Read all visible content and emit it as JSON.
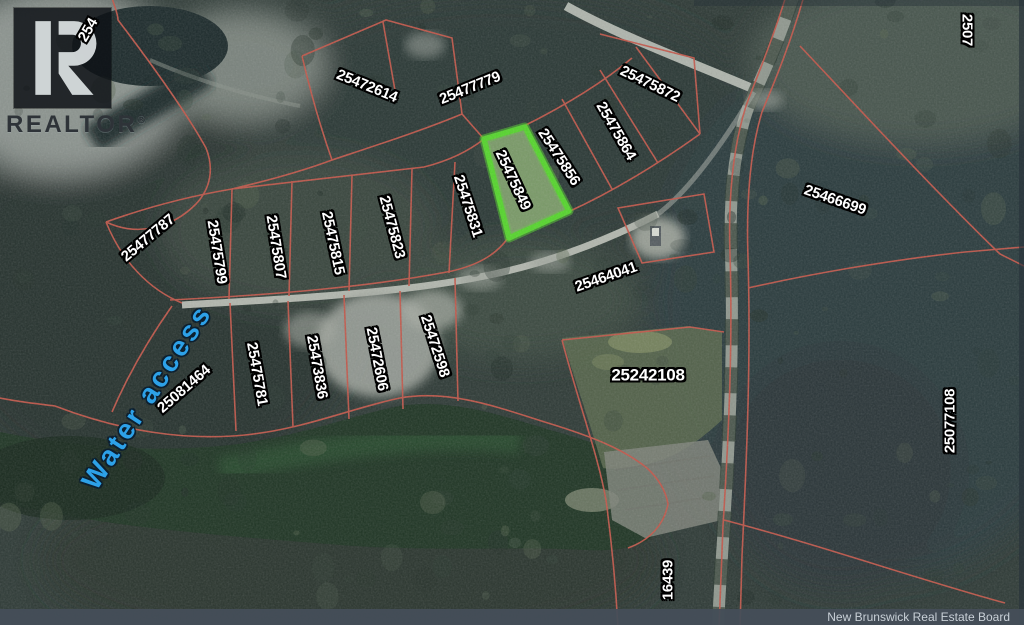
{
  "map": {
    "attribution": "New Brunswick Real Estate Board",
    "water_label": {
      "text": "Water access",
      "color": "#2da1e8",
      "rotation": -57
    },
    "logo": {
      "brand": "REALTOR",
      "registered": "®",
      "glyph": "R"
    },
    "highlight": {
      "parcel_id": "25475849",
      "border_color": "#55d42c"
    },
    "colors": {
      "parcel_line": "#c2574a",
      "label_fill": "#ffffff",
      "water": "#1f3524",
      "forest": "#2e3a36"
    },
    "parcels": [
      {
        "id": "254",
        "x": 88,
        "y": 30,
        "rot": -60,
        "partial": true
      },
      {
        "id": "25472614",
        "x": 367,
        "y": 86,
        "rot": 22
      },
      {
        "id": "25477779",
        "x": 470,
        "y": 88,
        "rot": -22
      },
      {
        "id": "25475872",
        "x": 650,
        "y": 84,
        "rot": 26
      },
      {
        "id": "25475864",
        "x": 616,
        "y": 131,
        "rot": 60
      },
      {
        "id": "25475856",
        "x": 559,
        "y": 157,
        "rot": 57
      },
      {
        "id": "25475849",
        "x": 513,
        "y": 180,
        "rot": 65,
        "highlight": true
      },
      {
        "id": "25475831",
        "x": 468,
        "y": 206,
        "rot": 72
      },
      {
        "id": "25475823",
        "x": 392,
        "y": 227,
        "rot": 75
      },
      {
        "id": "25475815",
        "x": 333,
        "y": 243,
        "rot": 78
      },
      {
        "id": "25475807",
        "x": 276,
        "y": 247,
        "rot": 81
      },
      {
        "id": "25475799",
        "x": 217,
        "y": 252,
        "rot": 81
      },
      {
        "id": "25477787",
        "x": 148,
        "y": 238,
        "rot": -40
      },
      {
        "id": "25466699",
        "x": 835,
        "y": 200,
        "rot": 19
      },
      {
        "id": "25464041",
        "x": 606,
        "y": 277,
        "rot": -19
      },
      {
        "id": "2507",
        "x": 967,
        "y": 30,
        "rot": 90,
        "partial": true
      },
      {
        "id": "25077108",
        "x": 950,
        "y": 421,
        "rot": -90
      },
      {
        "id": "25242108",
        "x": 648,
        "y": 375,
        "rot": 0,
        "size": 17
      },
      {
        "id": "25081464",
        "x": 184,
        "y": 389,
        "rot": -41
      },
      {
        "id": "25475781",
        "x": 257,
        "y": 374,
        "rot": 80
      },
      {
        "id": "25473836",
        "x": 317,
        "y": 367,
        "rot": 80
      },
      {
        "id": "25472606",
        "x": 377,
        "y": 359,
        "rot": 79
      },
      {
        "id": "25472598",
        "x": 435,
        "y": 346,
        "rot": 72
      },
      {
        "id": "16439",
        "x": 668,
        "y": 580,
        "rot": -90
      }
    ]
  }
}
